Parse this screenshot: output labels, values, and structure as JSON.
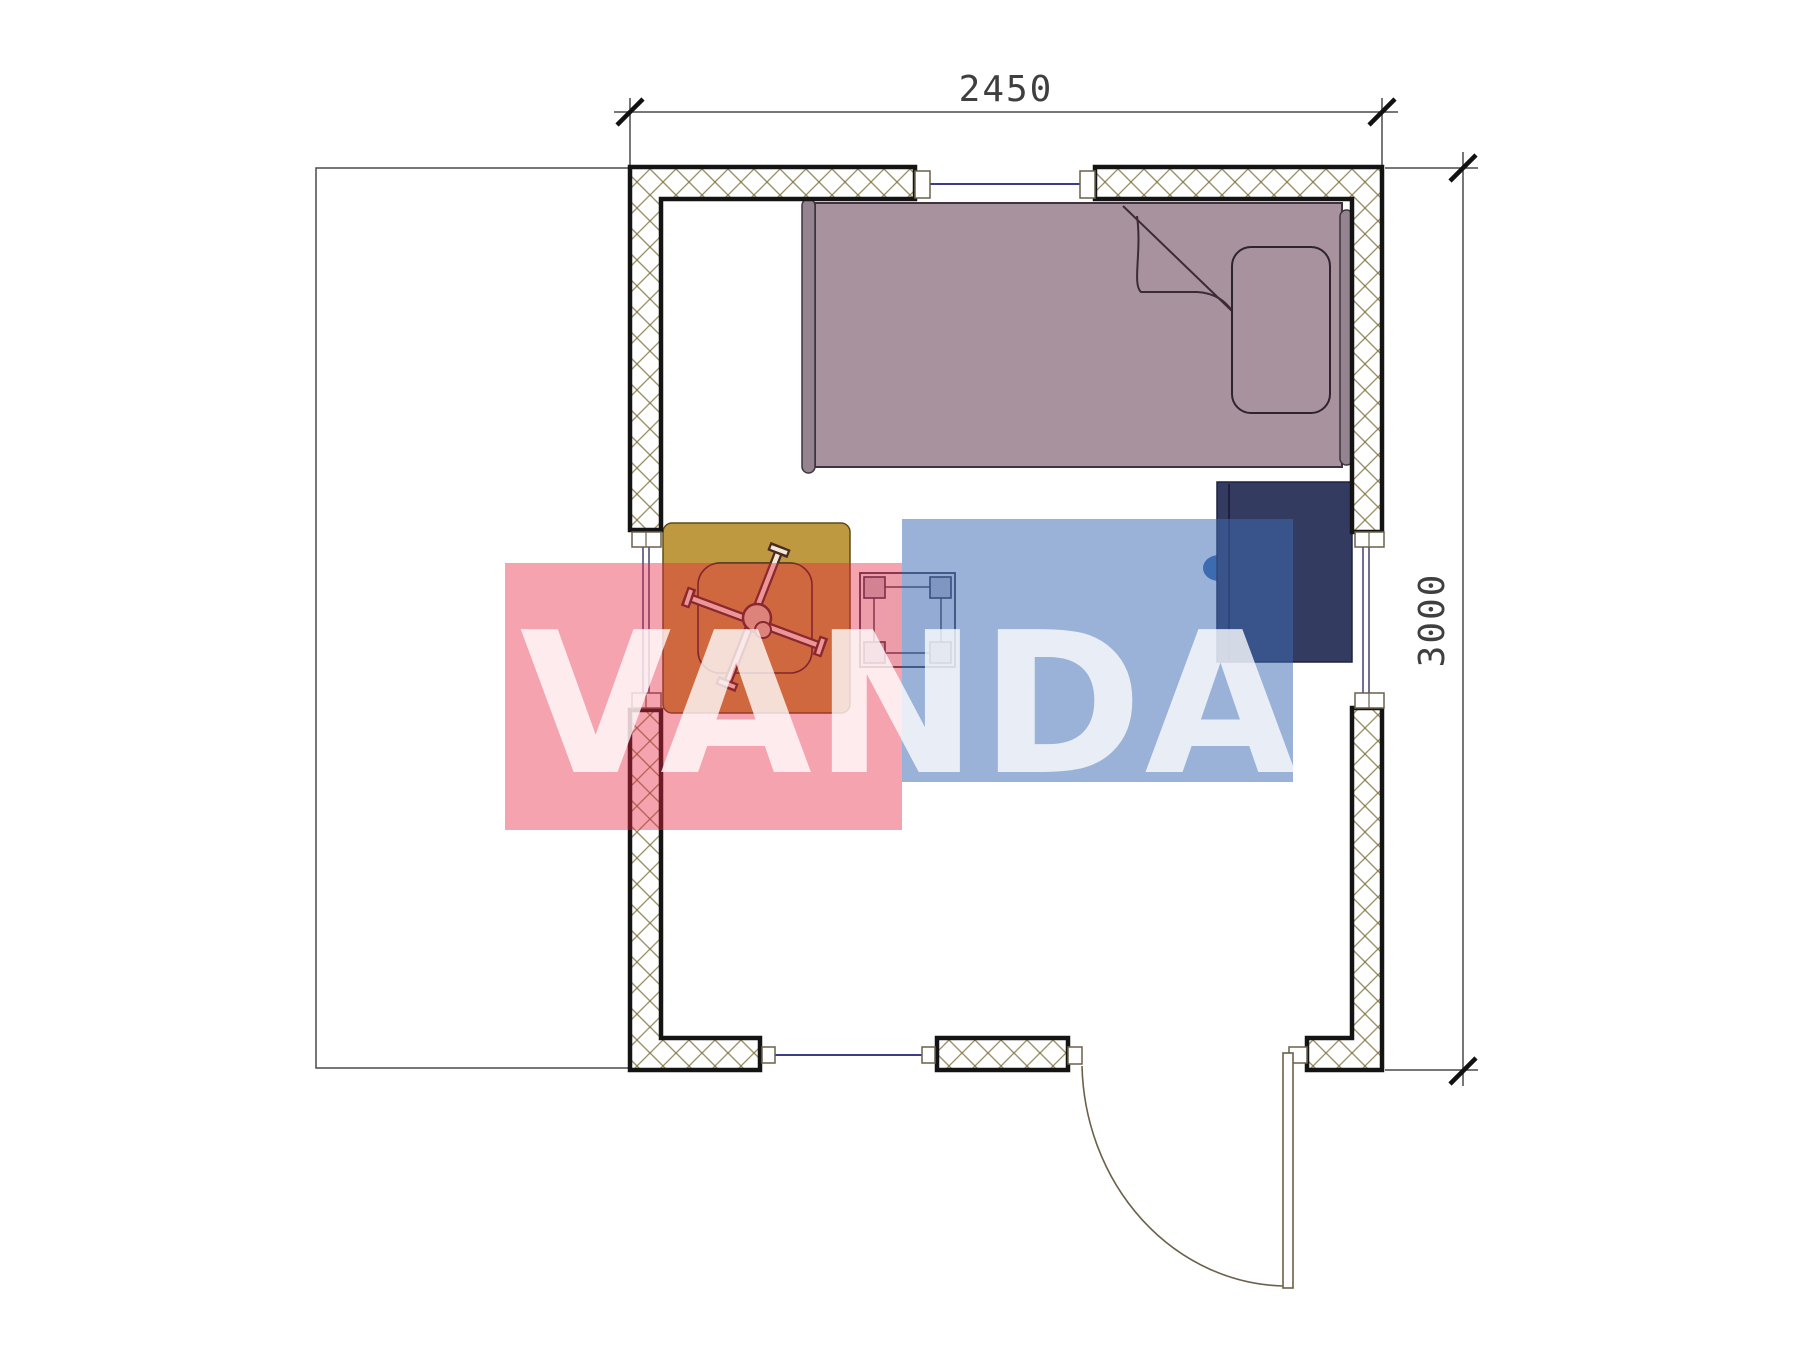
{
  "dimensions": {
    "width_label": "2450",
    "height_label": "3000"
  },
  "watermark": {
    "text": "VANDA",
    "red": "#e42340",
    "blue": "#3e6cb2",
    "letter_color": "#ffffff"
  },
  "colors": {
    "wall_outline": "#141414",
    "wall_hatch": "#9a8f66",
    "bed_fill": "#a8929e",
    "bed_outline": "#3f3340",
    "bed_rail_fill": "#948490",
    "pillow_fill": "#a8929e",
    "table_fill": "#bf993f",
    "table_outline": "#5f4a1d",
    "cabinet_fill": "#343b60",
    "cabinet_knob": "#2b3566",
    "stool_outline": "#34344a",
    "window_line": "#3c3c8c",
    "dimension_color": "#3f3f3f",
    "door_line": "#6b6148"
  },
  "symbols": {
    "wall_fill": "cross-hatch",
    "window": "double-line-with-sill-blocks",
    "door_swing": "quarter-arc",
    "table_stand": "x-frame"
  }
}
